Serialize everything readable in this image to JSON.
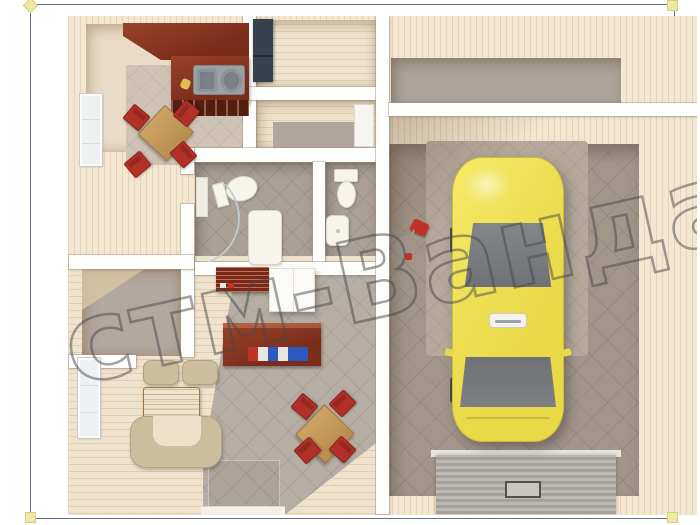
{
  "watermark": {
    "text": "стм-Ванда"
  },
  "frame": {
    "style": "selection-box",
    "handle_positions": [
      "top-left",
      "top-right",
      "bottom-left",
      "bottom-right"
    ]
  },
  "palette": {
    "frame_border": "#5f7191",
    "handle_yellow": "#efe8a6",
    "exterior_wall_wood": "#f3e7d2",
    "interior_wall_white": "#fdfdfc",
    "gray_tile": "#aaa098",
    "living_wood_floor": "#f0e3cd",
    "kitchen_counter_mahogany": "#8a3a22",
    "chair_red": "#b13028",
    "table_wood": "#c9a05f",
    "sofa_beige": "#cdbd9f",
    "fridge_navy": "#37424c",
    "car_yellow": "#f0e352",
    "car_glass": "#75787b",
    "garage_floor": "#a2968b",
    "parking_mat": "#b6a99c",
    "ramp_gray": "#aba7a2"
  },
  "scene": {
    "type": "3d-floor-plan-top-view",
    "rooms": [
      "kitchen",
      "utility-room",
      "corridor",
      "bathroom-large",
      "bathroom-small",
      "storage-room",
      "living-room",
      "garage",
      "garage-annex"
    ],
    "furniture": [
      "kitchen-counter",
      "double-sink",
      "kitchen-table",
      "red-chairs",
      "refrigerator",
      "toilet",
      "shower-glass",
      "water-heater",
      "wash-basin",
      "wardrobe-white",
      "shoe-rack",
      "desk",
      "books",
      "sofa-set",
      "coffee-table",
      "dining-table",
      "windows",
      "door-mat"
    ],
    "vehicle": {
      "type": "car-top-view",
      "color": "#f0e352"
    },
    "garage_items": [
      "red-tool-cart",
      "ribbed-ramp",
      "floor-drain",
      "parking-mat"
    ]
  }
}
